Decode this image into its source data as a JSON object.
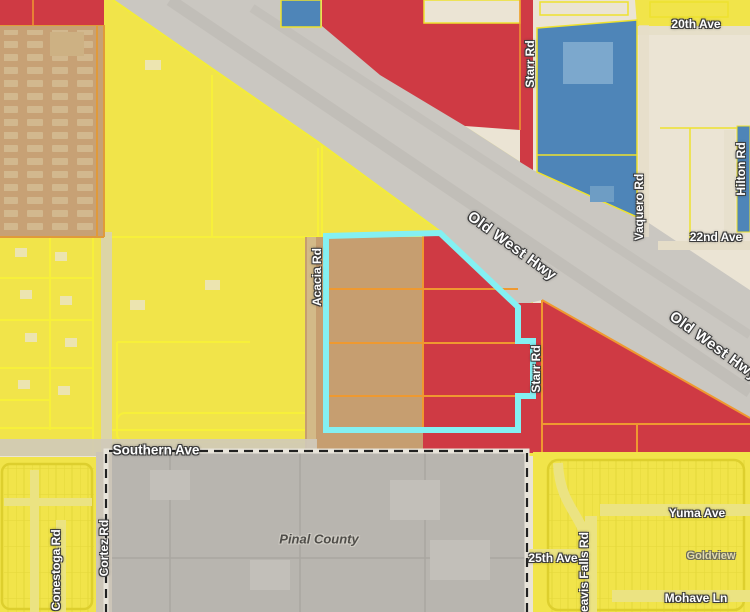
{
  "map": {
    "title": "zoning-parcel-map",
    "labels": {
      "twentieth_ave": "20th Ave",
      "starr_rd_north": "Starr Rd",
      "vaquero_rd": "Vaquero Rd",
      "hilton_rd": "Hilton Rd",
      "twentysecond_ave": "22nd Ave",
      "old_west_hwy_1": "Old West Hwy",
      "old_west_hwy_2": "Old West Hwy",
      "acacia_rd": "Acacia Rd",
      "starr_rd_south": "Starr Rd",
      "southern_ave": "Southern Ave",
      "cortez_rd": "Cortez Rd",
      "conestoga_rd": "Conestoga Rd",
      "pinal_county": "Pinal County",
      "twentyfifth_ave": "25th Ave",
      "yuma_ave": "Yuma Ave",
      "goldview": "Goldview",
      "mohave_ln": "Mohave Ln",
      "leavis_falls_rd": "eavis Falls Rd"
    },
    "colors": {
      "cream": "#ebe4d4",
      "yellow": "#f1e44a",
      "yellow_line": "#f4ec38",
      "red": "#cf3a44",
      "orange_line": "#ef9930",
      "blue": "#4e85b8",
      "tan": "#c69e70",
      "tan_park": "#c7a175",
      "highway_gray": "#cac7c1",
      "county_gray": "#b8b5af",
      "county_line": "#a9a6a0",
      "road_pale": "#ebe382",
      "highlight_cyan": "#84f0f2"
    },
    "highlighted_parcel": {
      "outline_color": "#84f0f2",
      "note": ""
    },
    "county_boundary_label": "Pinal County"
  }
}
